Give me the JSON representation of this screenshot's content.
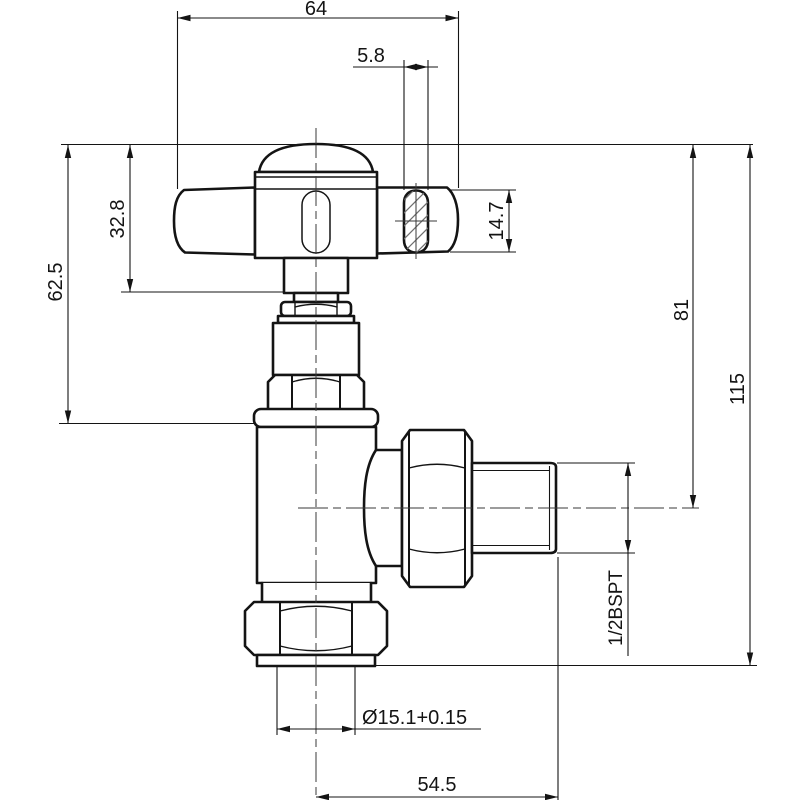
{
  "drawing": {
    "type": "engineering-dimension-drawing",
    "subject": "angled radiator valve, side elevation with cross handle",
    "background_color": "#ffffff",
    "line_color": "#141414",
    "dimensions": {
      "handle_width": "64",
      "handle_arm_section_width": "5.8",
      "handle_top_to_stem_base": "32.8",
      "handle_top_to_body_shoulder": "62.5",
      "handle_arm_section_height": "14.7",
      "handle_top_to_outlet_axis": "81",
      "overall_height": "115",
      "outlet_thread_spec": "1/2BSPT",
      "inlet_bore": "Ø15.1+0.15",
      "axis_to_outlet_end": "54.5"
    }
  }
}
